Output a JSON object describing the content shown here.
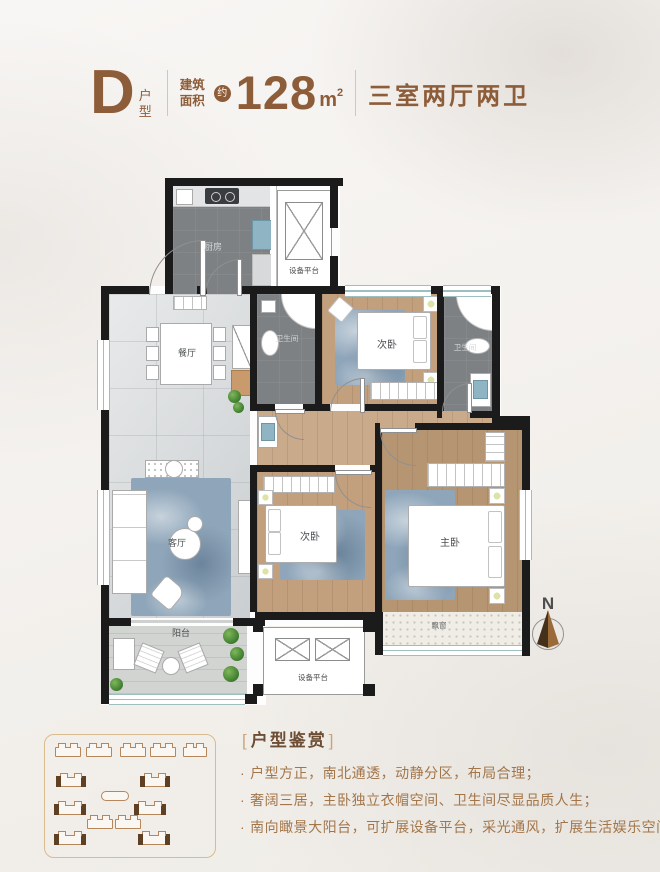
{
  "header": {
    "unit_letter": "D",
    "unit_type": "户型",
    "area_label": "建筑面积",
    "area_approx": "约",
    "area_value": "128",
    "area_unit": "m",
    "area_unit_exp": "2",
    "layout_text": "三室两厅两卫"
  },
  "plan": {
    "rooms": {
      "kitchen": "厨房",
      "equipment_top": "设备平台",
      "dining": "餐厅",
      "bath_1": "卫生间",
      "bedroom_top": "次卧",
      "bath_2": "卫生间",
      "living": "客厅",
      "bedroom_mid": "次卧",
      "master": "主卧",
      "balcony": "阳台",
      "equipment_bottom": "设备平台",
      "bay_window": "飘窗"
    },
    "compass_label": "N"
  },
  "features": {
    "bracket_open": "[",
    "title": "户型鉴赏",
    "bracket_close": "]",
    "bullet_marker": "·",
    "bullets": [
      "户型方正，南北通透，动静分区，布局合理；",
      "奢阔三居，主卧独立衣帽空间、卫生间尽显品质人生；",
      "南向瞰景大阳台，可扩展设备平台，采光通风，扩展生活娱乐空间；"
    ]
  },
  "colors": {
    "brand_brown": "#8d5c39",
    "feature_text": "#a3764a",
    "wall": "#1a1a1a",
    "window_teal": "#9dbfc0"
  }
}
